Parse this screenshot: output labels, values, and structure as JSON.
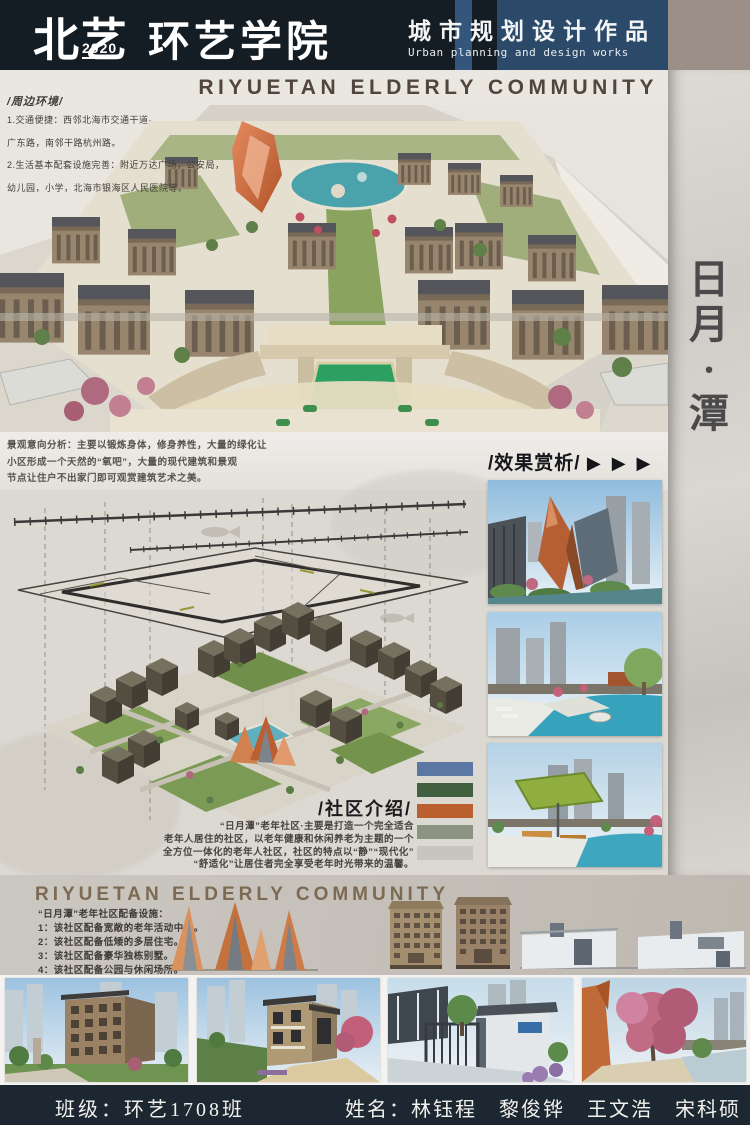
{
  "header": {
    "school": "北艺",
    "year": "2020",
    "college": "环艺学院",
    "title_cn": "城市规划设计作品",
    "title_en": "Urban planning and design works"
  },
  "banner": {
    "title": "RIYUETAN ELDERLY COMMUNITY"
  },
  "hero_overlay": {
    "title": "/周边环境/",
    "lines": [
      "1.交通便捷：西邻北海市交通干道·",
      "广东路，南邻干路杭州路。",
      "2.生活基本配套设施完善：附近万达广场，公安局，",
      "幼儿园，小学，北海市银海区人民医院等。"
    ]
  },
  "analysis": {
    "lines": [
      "景观意向分析：主要以锻炼身体，修身养性，大量的绿化让",
      "小区形成一个天然的“氧吧”，大量的现代建筑和景观",
      "节点让住户不出家门即可观赏建筑艺术之美。"
    ],
    "effects_title": "/效果赏析/",
    "effects_arrows": "▶ ▶ ▶"
  },
  "side_strip": {
    "char_1": "日",
    "char_2": "月",
    "char_3": "·",
    "char_4": "潭"
  },
  "community": {
    "heading": "/社区介绍/",
    "lines": [
      "“日月潭”老年社区·主要是打造一个完全适合",
      "老年人居住的社区，以老年健康和休闲养老为主题的一个",
      "全方位一体化的老年人社区，社区的特点以“静”“现代化”",
      "“舒适化”让居住者完全享受老年时光带来的温馨。"
    ],
    "palette": [
      "#5b77a3",
      "#41603f",
      "#b9602e",
      "#8d9383",
      "#c8c5c0"
    ]
  },
  "section2": {
    "heading": "RIYUETAN ELDERLY COMMUNITY",
    "list_title": "“日月潭”老年社区配备设施：",
    "items": [
      "1：该社区配备宽敞的老年活动中心。",
      "2：该社区配备低矮的多层住宅。",
      "3：该社区配备豪华独栋别墅。",
      "4：该社区配备公园与休闲场所。"
    ]
  },
  "footer": {
    "class_label": "班级：环艺1708班",
    "names_label": "姓名：林钰程　黎俊铧　王文浩　宋科硕"
  }
}
